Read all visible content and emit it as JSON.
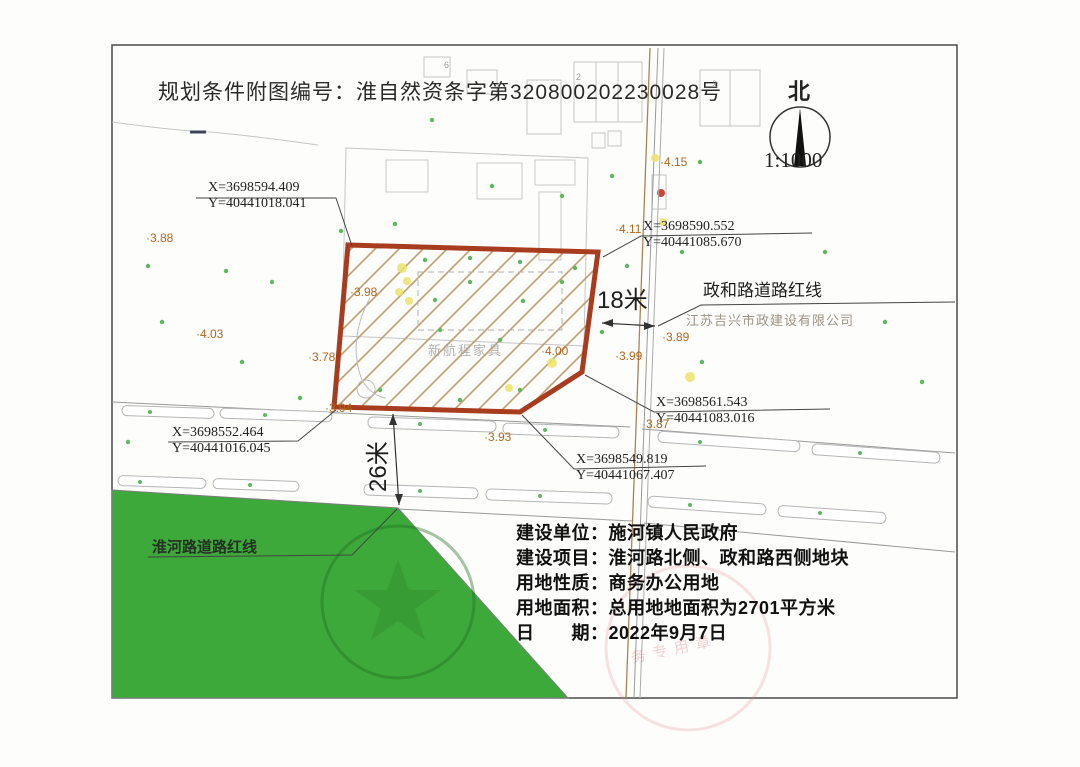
{
  "title": "规划条件附图编号：淮自然资条字第320800202230028号",
  "north": {
    "label": "北",
    "scale": "1:1000"
  },
  "roads": {
    "zhenghe_label": "政和路道路红线",
    "zhenghe_width": "18米",
    "huaihe_label": "淮河路道路红线",
    "huaihe_width": "26米"
  },
  "plot": {
    "interior_label": "新航程家具"
  },
  "watermarks": {
    "company": "江苏吉兴市政建设有限公司",
    "seal_text": "务专用章"
  },
  "coords": [
    {
      "x": "X=3698594.409",
      "y": "Y=40441018.041"
    },
    {
      "x": "X=3698590.552",
      "y": "Y=40441085.670"
    },
    {
      "x": "X=3698561.543",
      "y": "Y=40441083.016"
    },
    {
      "x": "X=3698552.464",
      "y": "Y=40441016.045"
    },
    {
      "x": "X=3698549.819",
      "y": "Y=40441067.407"
    }
  ],
  "elevations": [
    {
      "label": "·3.88"
    },
    {
      "label": "·4.03"
    },
    {
      "label": "·3.78"
    },
    {
      "label": "·3.98"
    },
    {
      "label": "·4.00"
    },
    {
      "label": "·3.94"
    },
    {
      "label": "·3.93"
    },
    {
      "label": "·3.99"
    },
    {
      "label": "·3.89"
    },
    {
      "label": "·3.87"
    },
    {
      "label": "·4.11"
    },
    {
      "label": "·4.15"
    }
  ],
  "building_numbers": [
    "6",
    "2",
    "2"
  ],
  "info": {
    "lines": [
      "建设单位：施河镇人民政府",
      "建设项目：淮河路北侧、政和路西侧地块",
      "用地性质：商务办公用地",
      "用地面积：总用地地面积为2701平方米",
      "日　　期：2022年9月7日"
    ]
  },
  "colors": {
    "red_line": "#a83c1e",
    "hatch_color": "#c49a6a",
    "green_area": "#3da93a",
    "elev_color": "#b5651d",
    "dot_green": "#5cb85c"
  }
}
